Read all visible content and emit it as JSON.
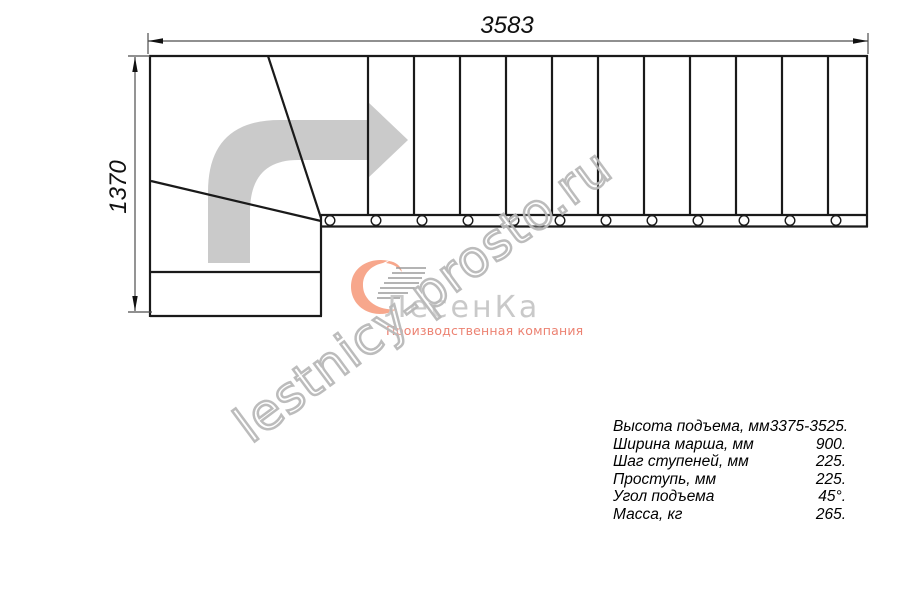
{
  "drawing": {
    "title": "staircase-plan-view",
    "dimensions": {
      "width_label": "3583",
      "height_label": "1370"
    },
    "treads": {
      "straight_count": 12,
      "winder_lines": 2,
      "baluster_circles": 12
    }
  },
  "watermark": {
    "text": "lestnicy-prosto.ru"
  },
  "logo": {
    "name": "ЛесенКа",
    "tagline": "Производственная компания",
    "name_color": "#c9c9c9",
    "tagline_color": "#ec8272",
    "swoosh_color": "#f7a78c"
  },
  "specs": {
    "rows": [
      {
        "label": "Высота подъема, мм",
        "value": "3375-3525."
      },
      {
        "label": "Ширина марша, мм",
        "value": "900."
      },
      {
        "label": "Шаг ступеней, мм",
        "value": "225."
      },
      {
        "label": "Проступь, мм",
        "value": "225."
      },
      {
        "label": "Угол подъема",
        "value": "45°."
      },
      {
        "label": "Масса, кг",
        "value": "265."
      }
    ]
  },
  "colors": {
    "line": "#1a1a1a",
    "dim_line": "#4d4d4d",
    "direction_arrow": "#cacaca",
    "watermark_stroke": "#b9b9b9"
  }
}
